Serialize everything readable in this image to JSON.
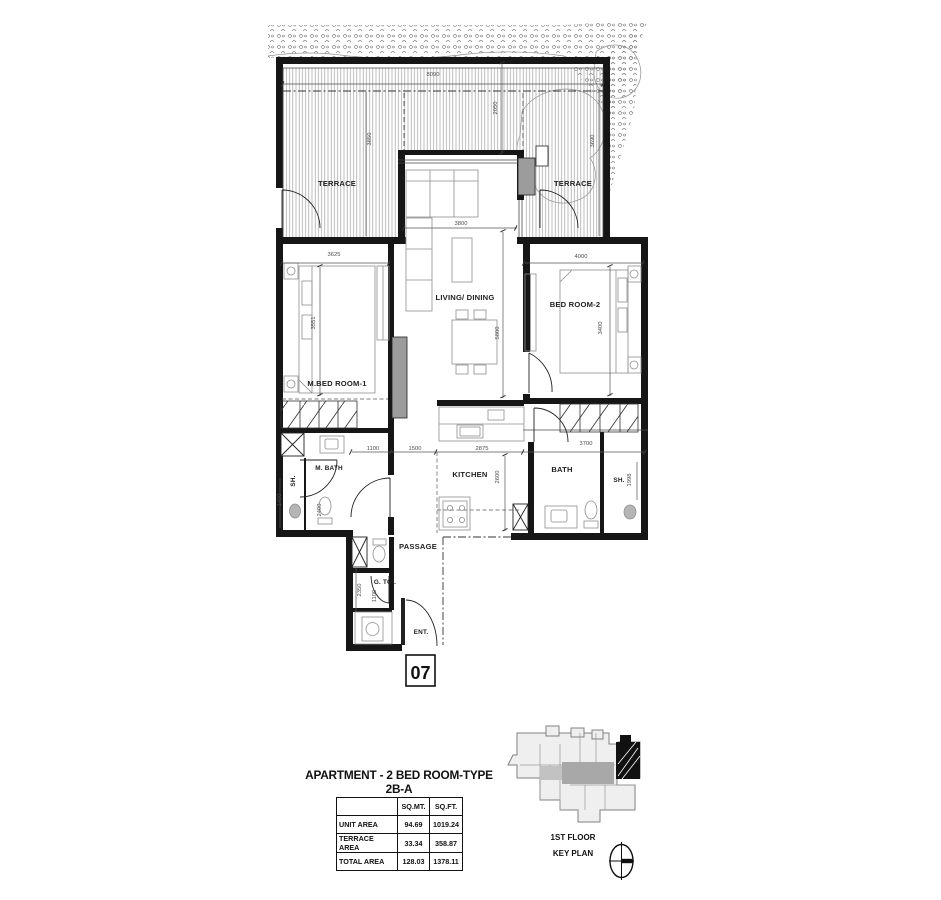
{
  "plan": {
    "unit_number": "07",
    "rooms": [
      {
        "label": "TERRACE"
      },
      {
        "label": "TERRACE"
      },
      {
        "label": "LIVING/ DINING"
      },
      {
        "label": "BED ROOM-2"
      },
      {
        "label": "M.BED ROOM-1"
      },
      {
        "label": "M. BATH"
      },
      {
        "label": "SH."
      },
      {
        "label": "KITCHEN"
      },
      {
        "label": "BATH"
      },
      {
        "label": "SH."
      },
      {
        "label": "PASSAGE"
      },
      {
        "label": "G. TOI."
      },
      {
        "label": "ENT."
      }
    ],
    "dimensions_mm": [
      {
        "value": "8090"
      },
      {
        "value": "2050"
      },
      {
        "value": "3850"
      },
      {
        "value": "3690"
      },
      {
        "value": "3800"
      },
      {
        "value": "3625"
      },
      {
        "value": "4000"
      },
      {
        "value": "3551"
      },
      {
        "value": "5800"
      },
      {
        "value": "3400"
      },
      {
        "value": "1100"
      },
      {
        "value": "1500"
      },
      {
        "value": "2875"
      },
      {
        "value": "3700"
      },
      {
        "value": "2600"
      },
      {
        "value": "1998"
      },
      {
        "value": "1400"
      },
      {
        "value": "2400"
      },
      {
        "value": "2350"
      },
      {
        "value": "1100"
      }
    ]
  },
  "summary": {
    "title": "APARTMENT - 2 BED ROOM-TYPE 2B-A",
    "table": {
      "col_headers": [
        "SQ.MT.",
        "SQ.FT."
      ],
      "rows": [
        {
          "label": "UNIT AREA",
          "sq_mt": "94.69",
          "sq_ft": "1019.24"
        },
        {
          "label": "TERRACE AREA",
          "sq_mt": "33.34",
          "sq_ft": "358.87"
        },
        {
          "label": "TOTAL AREA",
          "sq_mt": "128.03",
          "sq_ft": "1378.11"
        }
      ]
    }
  },
  "key_plan": {
    "floor_label": "1ST FLOOR",
    "plan_label": "KEY PLAN"
  }
}
